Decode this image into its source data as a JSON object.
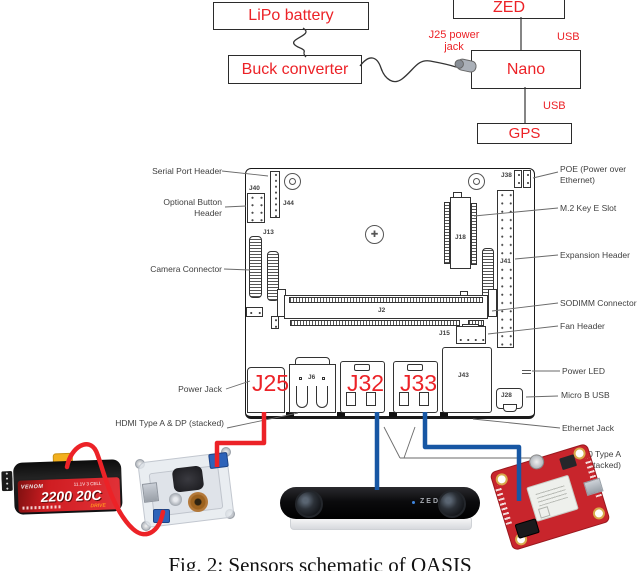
{
  "colors": {
    "accent_red": "#ec2227",
    "wire_blue": "#1757a4",
    "label_gray": "#3f3f3f"
  },
  "top_diagram": {
    "lipo_label": "LiPo battery",
    "buck_label": "Buck converter",
    "zed_label": "ZED",
    "nano_label": "Nano",
    "gps_label": "GPS",
    "j25_jack_label": "J25 power jack",
    "usb_top_label": "USB",
    "usb_bottom_label": "USB"
  },
  "board": {
    "left_labels": [
      "Serial Port Header",
      "Optional Button Header",
      "Camera Connector",
      "Power Jack",
      "HDMI Type A & DP (stacked)"
    ],
    "right_labels": [
      "POE (Power over Ethernet)",
      "M.2 Key E Slot",
      "Expansion Header",
      "SODIMM Connector",
      "Fan Header",
      "Power LED",
      "Micro B USB",
      "Ethernet Jack",
      "USB 3.0 Type A (stacked)"
    ],
    "refs": {
      "j40": "J40",
      "j44": "J44",
      "j13": "J13",
      "j38": "J38",
      "j18": "J18",
      "j41": "J41",
      "j2": "J2",
      "j15": "J15",
      "j6": "J6",
      "j43": "J43",
      "j28": "J28"
    },
    "ports": {
      "j25": "J25",
      "j32": "J32",
      "j33": "J33"
    }
  },
  "photos": {
    "battery": {
      "brand": "VENOM",
      "rating": "2200 20C",
      "spec": "11.1V 3 CELL",
      "series": "DRIVE"
    },
    "zed": {
      "label": "ZED"
    }
  },
  "caption": "Fig. 2: Sensors schematic of OASIS"
}
